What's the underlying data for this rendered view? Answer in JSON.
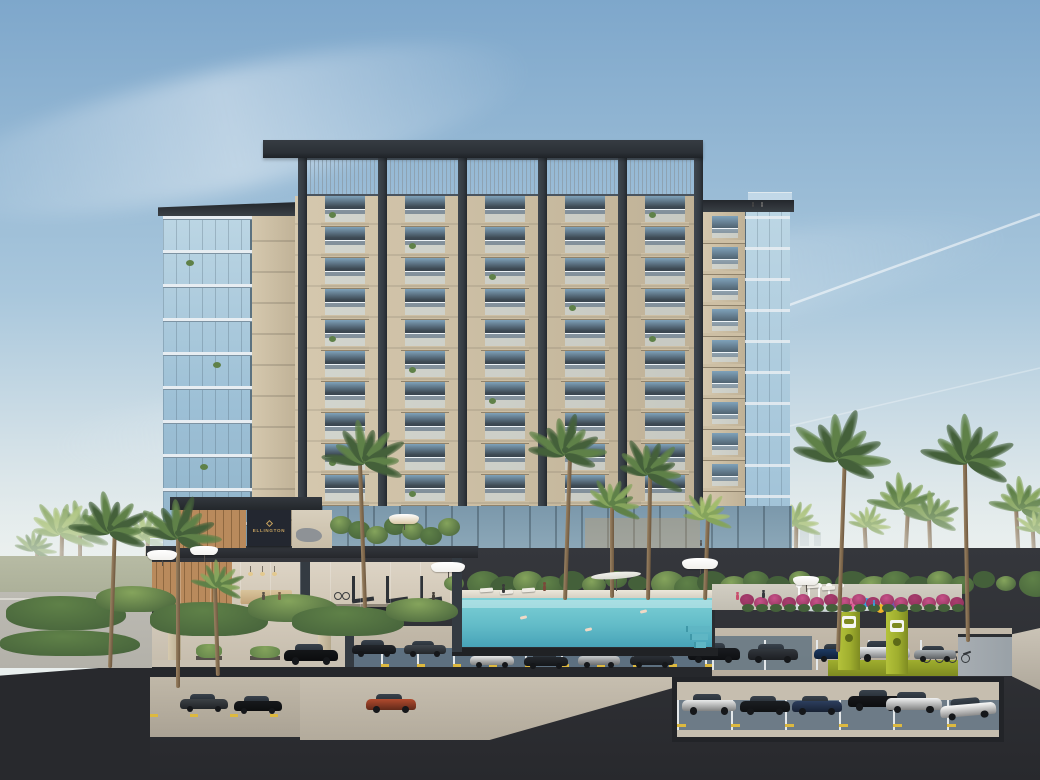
{
  "scene": {
    "type": "architectural-rendering",
    "subject": "residential tower cross-section with rooftop-crown pergola, glass wings, amenity level, pool, splash pad, EV charging and underground parking",
    "sign": {
      "brand": "ELLINGTON"
    },
    "icons": [
      "ev-charging-icon",
      "palm-tree-icon"
    ],
    "palette": {
      "skyTop": "#7ea7cb",
      "skyMid": "#a9c7dc",
      "skyHorizon": "#dde7ea",
      "facade": "#d5c8ae",
      "facadeShade": "#bfb196",
      "pier": "#cfc2a7",
      "slabLine": "#cdbfa4",
      "slabShadow": "#8f826b",
      "column": "#343b42",
      "roof": "#2b3036",
      "slat": "#8ea3b3",
      "glassLight": "#bcd6e4",
      "glassMid": "#9dc0d6",
      "glassEdge": "#5c7280",
      "winDark": "#3d4953",
      "winRef": "#7fa2ba",
      "wood": "#b98a5c",
      "woodDark": "#8f6840",
      "signBg": "#232730",
      "signGold": "#c6a25f",
      "deckDark": "#26282c",
      "concrete": "#b6ac9d",
      "concreteLight": "#c6beaf",
      "stall": "#5d7080",
      "stallLine": "#e4e8ea",
      "wheelStop": "#ddb93f",
      "pool": "#7ed0d6",
      "poolDeep": "#47a3b8",
      "lime": "#9fae2e",
      "limeDark": "#7e8b21",
      "earth": "#35373c",
      "earthDark": "#28292d",
      "greenDark": "#44603a",
      "green": "#5f8148",
      "greenLight": "#85a45c",
      "frondLight": "#a3bd6d",
      "pink": "#c8528a",
      "road": "#b3b1a9",
      "wall": "#99a1a7",
      "skylineCol": "#b9c4c9"
    },
    "tower": {
      "floors": 10,
      "floorTop": 196,
      "floorH": 31,
      "left": 295,
      "right": 703,
      "strips": [
        325,
        405,
        485,
        565,
        645
      ],
      "stripW": 40,
      "columns": [
        298,
        378,
        458,
        538,
        618,
        694
      ],
      "columnW": 9,
      "roof": {
        "x": 263,
        "y": 140,
        "w": 440,
        "h": 18
      },
      "slatTop": 158,
      "slatBottom": 196
    },
    "leftWing": {
      "x": 163,
      "w": 89,
      "top": 216,
      "bottom": 556,
      "floorH": 34
    },
    "rightWing": {
      "beigeX": 703,
      "beigeW": 42,
      "glassX": 745,
      "glassW": 45,
      "top": 212,
      "bottom": 556,
      "floorH": 31
    },
    "skyline": [
      [
        736,
        524,
        8,
        22
      ],
      [
        748,
        516,
        10,
        30
      ],
      [
        762,
        528,
        7,
        18
      ],
      [
        773,
        521,
        12,
        25
      ],
      [
        788,
        530,
        8,
        16
      ],
      [
        800,
        526,
        9,
        20
      ],
      [
        814,
        532,
        7,
        14
      ]
    ],
    "bgPalms": [
      [
        34,
        614,
        66,
        22,
        1
      ],
      [
        80,
        630,
        100,
        32,
        1
      ],
      [
        145,
        622,
        86,
        28,
        2
      ],
      [
        250,
        626,
        88,
        28,
        1
      ],
      [
        300,
        612,
        78,
        26,
        2
      ],
      [
        416,
        602,
        92,
        28,
        1
      ],
      [
        300,
        660,
        120,
        34,
        0
      ],
      [
        60,
        648,
        118,
        34,
        2
      ],
      [
        730,
        562,
        58,
        20,
        2
      ],
      [
        757,
        602,
        86,
        26,
        1
      ],
      [
        795,
        602,
        80,
        26,
        2
      ],
      [
        868,
        592,
        68,
        22,
        2
      ],
      [
        902,
        622,
        118,
        34,
        1
      ],
      [
        932,
        602,
        86,
        28,
        1
      ],
      [
        1022,
        622,
        116,
        32,
        1
      ],
      [
        1036,
        592,
        64,
        22,
        2
      ]
    ],
    "fgPalms": [
      [
        110,
        668,
        140,
        40,
        0
      ],
      [
        178,
        688,
        155,
        42,
        0
      ],
      [
        218,
        676,
        92,
        27,
        1
      ],
      [
        365,
        608,
        150,
        42,
        0
      ],
      [
        565,
        600,
        150,
        40,
        0
      ],
      [
        612,
        598,
        95,
        29,
        1
      ],
      [
        648,
        600,
        130,
        36,
        0
      ],
      [
        705,
        600,
        85,
        27,
        2
      ],
      [
        838,
        652,
        198,
        50,
        0
      ],
      [
        968,
        642,
        185,
        47,
        0
      ]
    ],
    "cars": [
      {
        "x": 352,
        "y": 640,
        "w": 44,
        "c": "#22262b",
        "layer": "a"
      },
      {
        "x": 404,
        "y": 641,
        "w": 42,
        "c": "#40464d",
        "layer": "a"
      },
      {
        "x": 470,
        "y": 651,
        "w": 44,
        "c": "#e7e8e8",
        "layer": "a"
      },
      {
        "x": 524,
        "y": 652,
        "w": 44,
        "c": "#24282d",
        "layer": "a"
      },
      {
        "x": 578,
        "y": 652,
        "w": 42,
        "c": "#c7cacc",
        "layer": "a"
      },
      {
        "x": 630,
        "y": 651,
        "w": 44,
        "c": "#2b3036",
        "layer": "a"
      },
      {
        "x": 688,
        "y": 643,
        "w": 52,
        "c": "#191c20",
        "layer": "street"
      },
      {
        "x": 748,
        "y": 644,
        "w": 50,
        "c": "#32373d",
        "layer": "street"
      },
      {
        "x": 814,
        "y": 644,
        "w": 48,
        "c": "#1d3a64",
        "layer": "street"
      },
      {
        "x": 856,
        "y": 641,
        "w": 54,
        "c": "#eceff1",
        "layer": "street"
      },
      {
        "x": 914,
        "y": 646,
        "w": 42,
        "c": "#aab0b5",
        "layer": "street"
      },
      {
        "x": 682,
        "y": 694,
        "w": 54,
        "c": "#e9eaea",
        "layer": "inset"
      },
      {
        "x": 740,
        "y": 696,
        "w": 50,
        "c": "#1b1e22",
        "layer": "inset"
      },
      {
        "x": 792,
        "y": 696,
        "w": 50,
        "c": "#2c3e5e",
        "layer": "inset"
      },
      {
        "x": 848,
        "y": 690,
        "w": 54,
        "c": "#17191c",
        "layer": "inset"
      },
      {
        "x": 886,
        "y": 692,
        "w": 56,
        "c": "#f0f1f1",
        "layer": "inset"
      },
      {
        "x": 940,
        "y": 698,
        "w": 56,
        "c": "#fbfbfa",
        "r": -5,
        "layer": "inset"
      },
      {
        "x": 180,
        "y": 694,
        "w": 48,
        "c": "#3c4146",
        "layer": "b"
      },
      {
        "x": 234,
        "y": 696,
        "w": 48,
        "c": "#17191c",
        "layer": "b"
      },
      {
        "x": 366,
        "y": 694,
        "w": 50,
        "c": "#b14a2e",
        "layer": "d"
      },
      {
        "x": 284,
        "y": 644,
        "w": 54,
        "c": "#141619",
        "layer": "drop"
      }
    ],
    "umbrellas": [
      [
        448,
        562,
        34,
        "#f3f2ee"
      ],
      [
        700,
        558,
        36,
        "#f1f0ec"
      ],
      [
        404,
        514,
        30,
        "#d8c8a6"
      ],
      [
        162,
        550,
        30,
        "#f2f1ee"
      ],
      [
        204,
        546,
        28,
        "#f2f1ee"
      ],
      [
        806,
        576,
        26,
        "#eceae4"
      ]
    ],
    "sail": {
      "x": 616,
      "y": 572,
      "w": 50
    },
    "people": [
      [
        502,
        584,
        9,
        "#3a3a3a"
      ],
      [
        543,
        582,
        9,
        "#7a4a3a"
      ],
      [
        736,
        592,
        8,
        "#c94f6d"
      ],
      [
        762,
        590,
        8,
        "#35383c"
      ],
      [
        850,
        598,
        6,
        "#e06a9a"
      ],
      [
        873,
        600,
        6,
        "#3aa0d8"
      ],
      [
        262,
        592,
        8,
        "#5a5248"
      ],
      [
        278,
        592,
        8,
        "#7d6147"
      ],
      [
        432,
        592,
        8,
        "#46413a"
      ],
      [
        700,
        540,
        6,
        "#555555"
      ],
      [
        752,
        202,
        5,
        "#444444"
      ],
      [
        761,
        202,
        5,
        "#666666"
      ]
    ],
    "toys": [
      [
        846,
        602,
        "#e0609a"
      ],
      [
        862,
        598,
        "#35a3dc"
      ],
      [
        876,
        604,
        "#f0b429"
      ],
      [
        888,
        600,
        "#7b54a8"
      ]
    ],
    "jets": [
      798,
      808,
      818,
      828,
      840
    ]
  }
}
